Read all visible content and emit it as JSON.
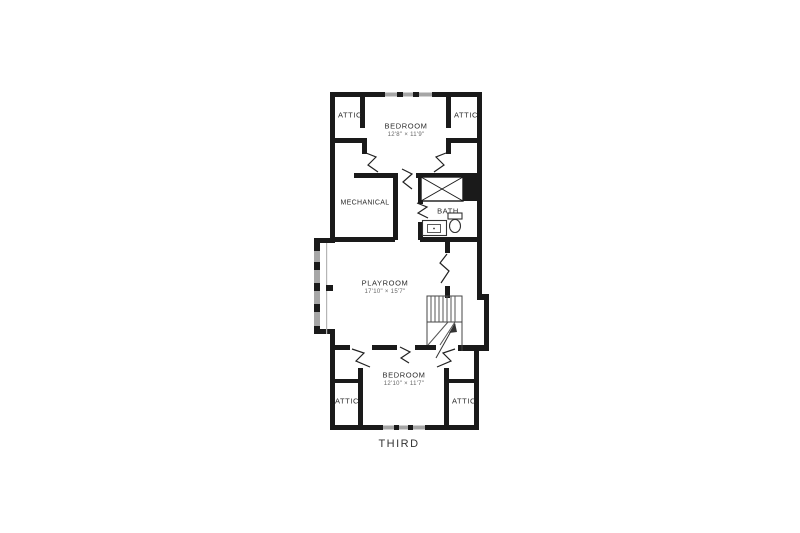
{
  "floor_plan": {
    "floor_label": "THIRD",
    "rooms": {
      "attic_top_left": {
        "label": "ATTIC"
      },
      "attic_top_right": {
        "label": "ATTIC"
      },
      "bedroom_top": {
        "label": "BEDROOM",
        "dims": "12'8\" × 11'9\""
      },
      "mechanical": {
        "label": "MECHANICAL"
      },
      "bath": {
        "label": "BATH"
      },
      "playroom": {
        "label": "PLAYROOM",
        "dims": "17'10\" × 15'7\""
      },
      "bedroom_bottom": {
        "label": "BEDROOM",
        "dims": "12'10\" × 11'7\""
      },
      "attic_bottom_left": {
        "label": "ATTIC"
      },
      "attic_bottom_right": {
        "label": "ATTIC"
      }
    },
    "colors": {
      "wall": "#1a1a1a",
      "window": "#a6a6a6",
      "text": "#333333",
      "background": "#ffffff"
    }
  }
}
